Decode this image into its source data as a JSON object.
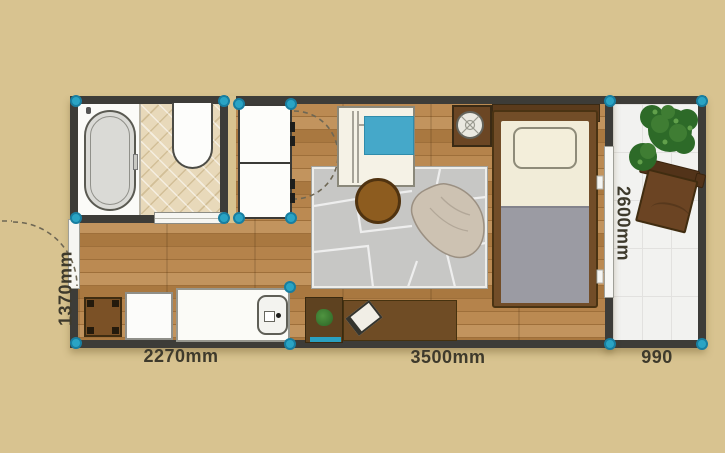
{
  "page": {
    "type": "apartment-floor-plan"
  },
  "dimension_labels": {
    "entry_height_left": "1370mm",
    "kitchen_bath_width": "2270mm",
    "living_width": "3500mm",
    "balcony_width": "990",
    "balcony_depth_right": "2600mm"
  },
  "colors": {
    "background": "#d8c390",
    "wall": "#3d3c38",
    "vertex_marker": "#2aa4c4",
    "wood_floor": "#b08048",
    "rug": "#c7c7c5",
    "sofa_cushion": "#45a8c9",
    "furniture_wood": "#6b4423",
    "bathroom_mat": "#e8d9ba",
    "balcony_tile": "#f2f2f0"
  },
  "furniture_icons": [
    "bathtub",
    "shower-tray",
    "sliding-door",
    "storage-cabinet",
    "entry-door",
    "sofa",
    "coffee-table",
    "rug",
    "bean-bag",
    "nightstand",
    "table-lamp",
    "bed",
    "pillow",
    "blanket",
    "kitchen-table",
    "washing-machine",
    "kitchen-counter",
    "sink",
    "desk",
    "desk-plant",
    "tablet",
    "balcony-chair",
    "potted-plant",
    "window"
  ]
}
